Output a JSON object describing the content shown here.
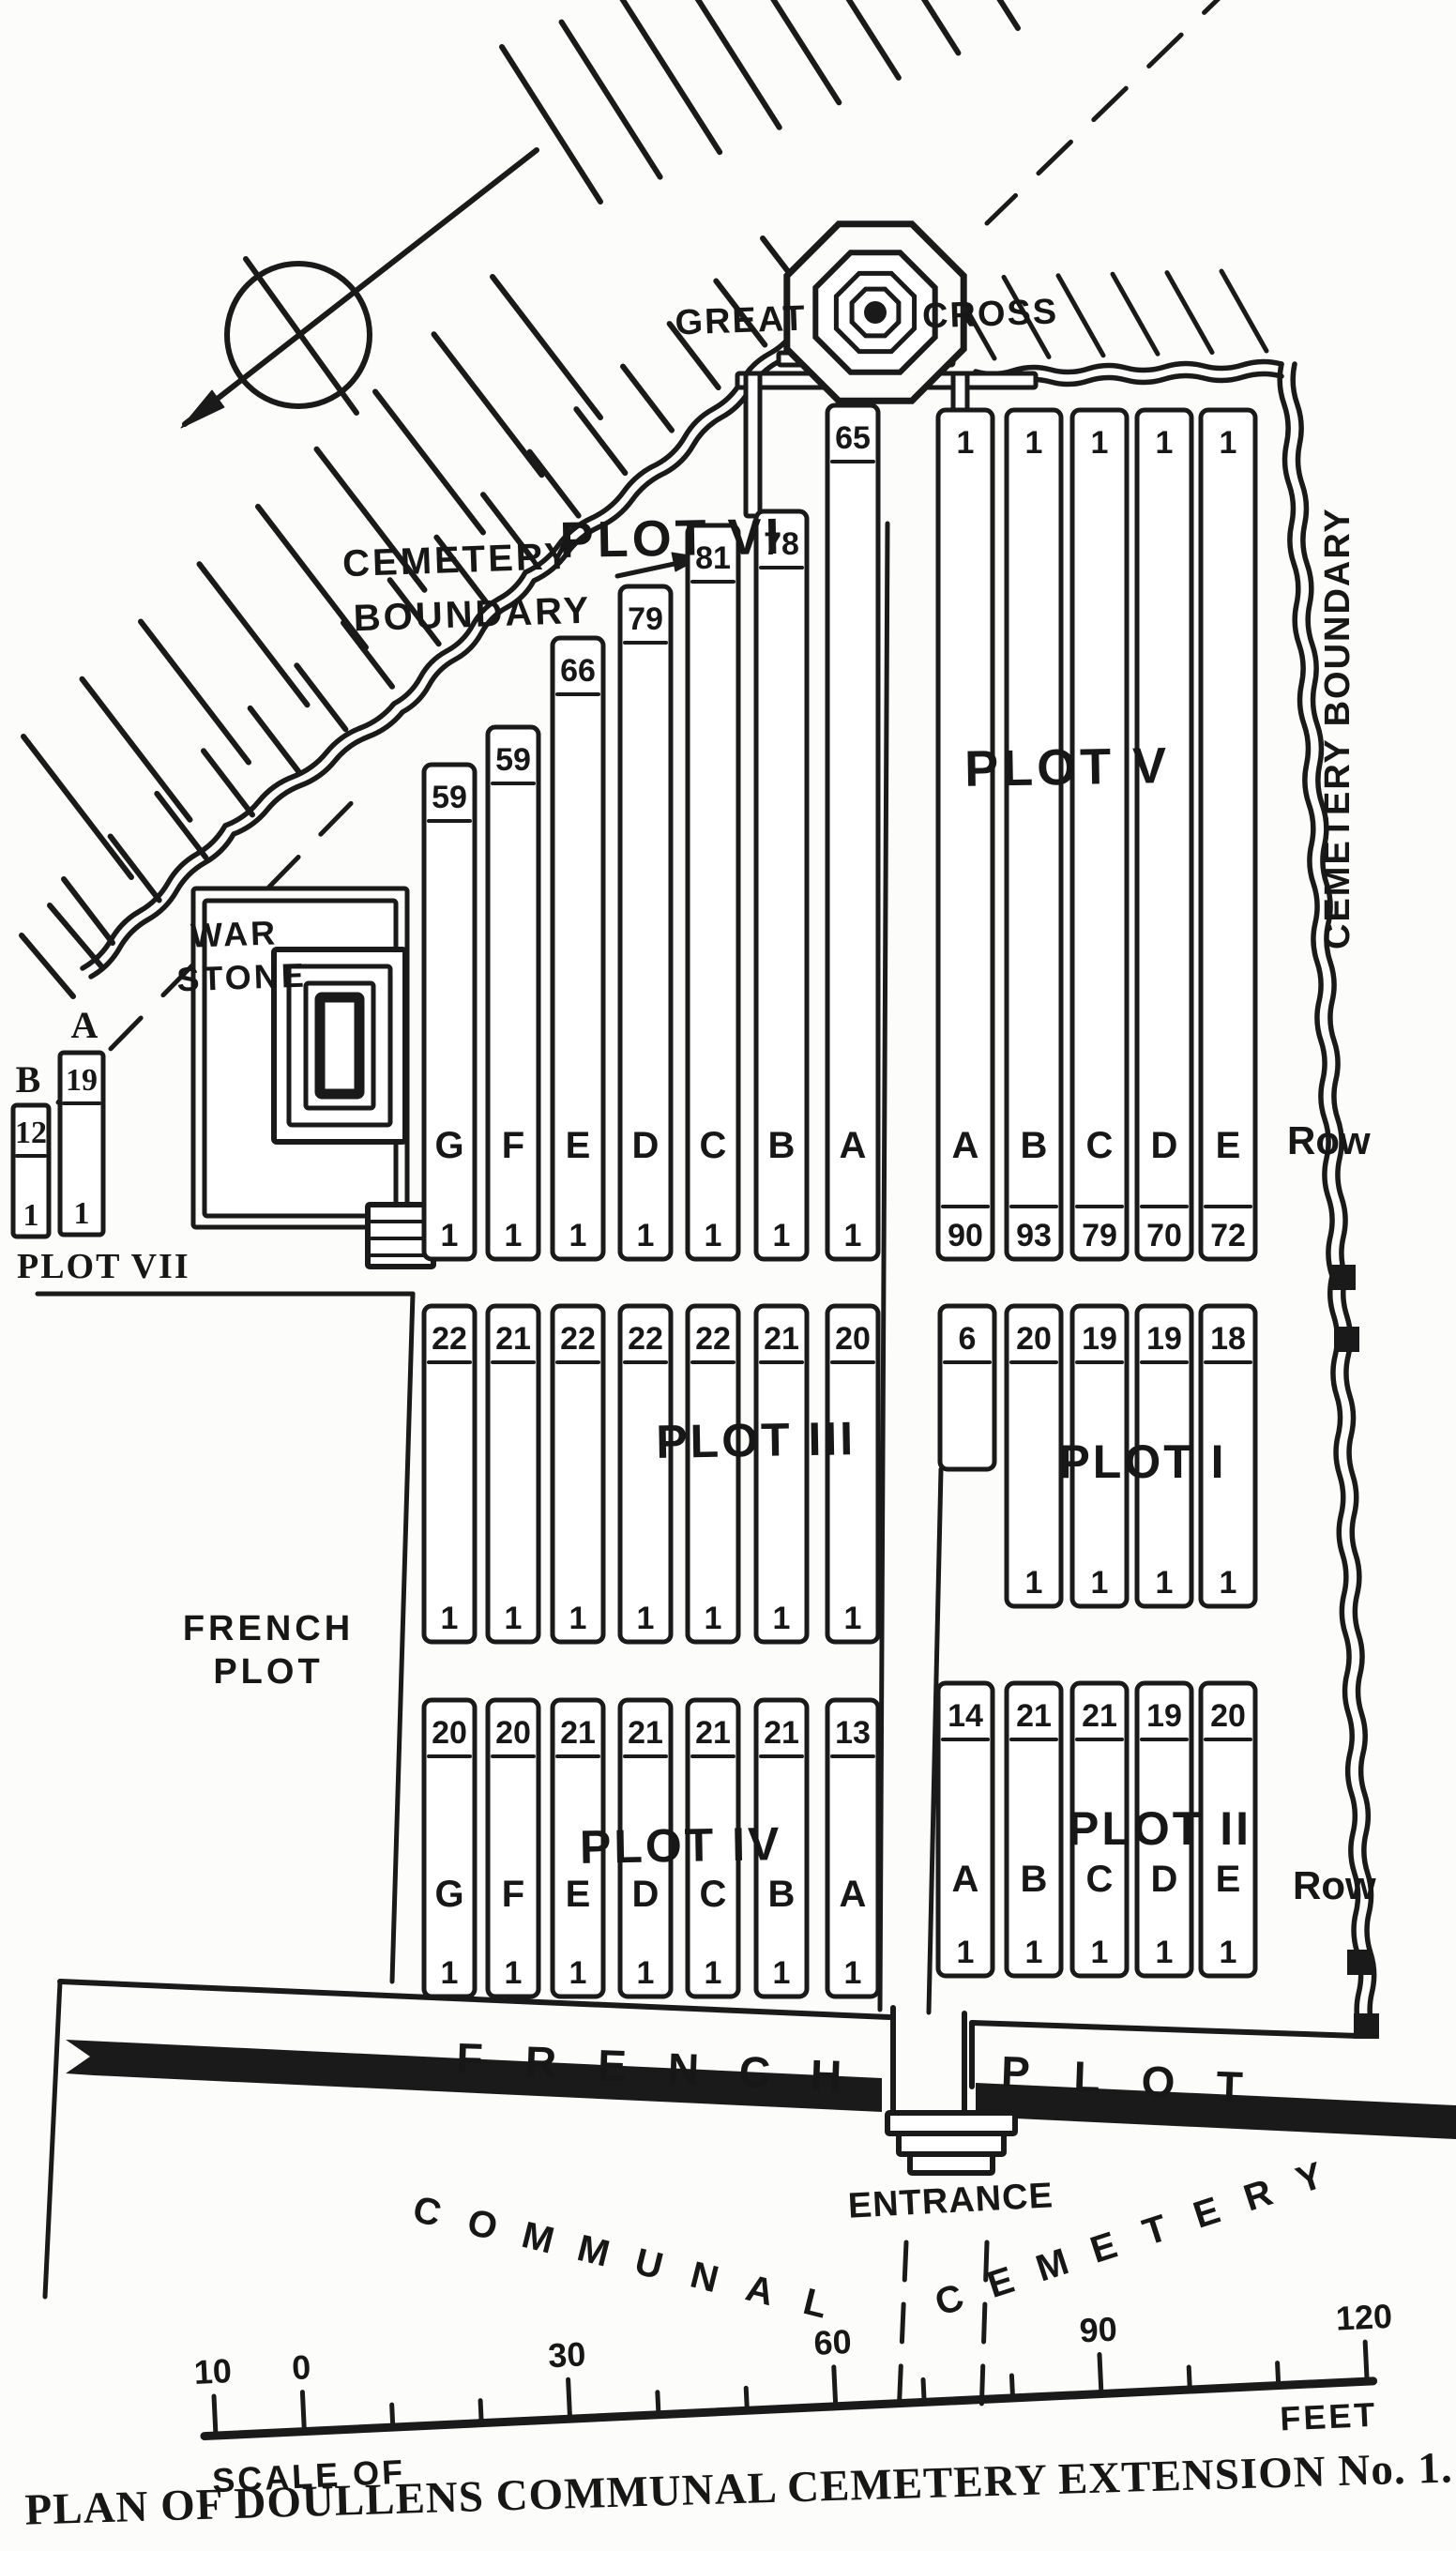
{
  "title": "PLAN OF DOULLENS COMMUNAL CEMETERY EXTENSION No. 1.",
  "colors": {
    "ink": "#1a1a1a",
    "paper": "#fcfcfa"
  },
  "labels": {
    "great": "GREAT",
    "cross": "CROSS",
    "nw_boundary": [
      "CEMETERY",
      "BOUNDARY"
    ],
    "e_boundary": "CEMETERY BOUNDARY",
    "war_stone": [
      "WAR",
      "STONE"
    ],
    "french_plot": [
      "FRENCH",
      "PLOT"
    ],
    "row": "Row",
    "french": "FRENCH",
    "plot": "PLOT",
    "communal": "COMMUNAL",
    "cemetery": "CEMETERY",
    "entrance": "ENTRANCE"
  },
  "scale": {
    "ticks": [
      "10",
      "0",
      "30",
      "60",
      "90",
      "120"
    ],
    "tick_feet": [
      -10,
      0,
      30,
      60,
      90,
      120
    ],
    "left_label": "SCALE OF",
    "right_label": "FEET"
  },
  "plots": {
    "v": {
      "name": "PLOT V",
      "rows": [
        {
          "letter": "A",
          "top": "1",
          "bottom": "90"
        },
        {
          "letter": "B",
          "top": "1",
          "bottom": "93"
        },
        {
          "letter": "C",
          "top": "1",
          "bottom": "79"
        },
        {
          "letter": "D",
          "top": "1",
          "bottom": "70"
        },
        {
          "letter": "E",
          "top": "1",
          "bottom": "72"
        }
      ]
    },
    "vi": {
      "name": "PLOT VI",
      "rows": [
        {
          "letter": "G",
          "top": "59",
          "bottom": "1"
        },
        {
          "letter": "F",
          "top": "59",
          "bottom": "1"
        },
        {
          "letter": "E",
          "top": "66",
          "bottom": "1"
        },
        {
          "letter": "D",
          "top": "79",
          "bottom": "1"
        },
        {
          "letter": "C",
          "top": "81",
          "bottom": "1"
        },
        {
          "letter": "B",
          "top": "78",
          "bottom": "1"
        },
        {
          "letter": "A",
          "top": "65",
          "bottom": "1"
        }
      ]
    },
    "iii": {
      "name": "PLOT III",
      "rows": [
        {
          "top": "22",
          "bottom": "1"
        },
        {
          "top": "21",
          "bottom": "1"
        },
        {
          "top": "22",
          "bottom": "1"
        },
        {
          "top": "22",
          "bottom": "1"
        },
        {
          "top": "22",
          "bottom": "1"
        },
        {
          "top": "21",
          "bottom": "1"
        },
        {
          "top": "20",
          "bottom": "1"
        }
      ]
    },
    "i": {
      "name": "PLOT I",
      "rows": [
        {
          "top": "6"
        },
        {
          "top": "20",
          "bottom": "1"
        },
        {
          "top": "19",
          "bottom": "1"
        },
        {
          "top": "19",
          "bottom": "1"
        },
        {
          "top": "18",
          "bottom": "1"
        }
      ]
    },
    "iv": {
      "name": "PLOT IV",
      "rows": [
        {
          "letter": "G",
          "top": "20",
          "bottom": "1"
        },
        {
          "letter": "F",
          "top": "20",
          "bottom": "1"
        },
        {
          "letter": "E",
          "top": "21",
          "bottom": "1"
        },
        {
          "letter": "D",
          "top": "21",
          "bottom": "1"
        },
        {
          "letter": "C",
          "top": "21",
          "bottom": "1"
        },
        {
          "letter": "B",
          "top": "21",
          "bottom": "1"
        },
        {
          "letter": "A",
          "top": "13",
          "bottom": "1"
        }
      ]
    },
    "ii": {
      "name": "PLOT II",
      "rows": [
        {
          "letter": "A",
          "top": "14",
          "bottom": "1"
        },
        {
          "letter": "B",
          "top": "21",
          "bottom": "1"
        },
        {
          "letter": "C",
          "top": "21",
          "bottom": "1"
        },
        {
          "letter": "D",
          "top": "19",
          "bottom": "1"
        },
        {
          "letter": "E",
          "top": "20",
          "bottom": "1"
        }
      ]
    },
    "vii": {
      "name": "PLOT VII",
      "rows": [
        {
          "letter": "B",
          "top": "12",
          "bottom": "1"
        },
        {
          "letter": "A",
          "top": "19",
          "bottom": "1"
        }
      ]
    }
  }
}
